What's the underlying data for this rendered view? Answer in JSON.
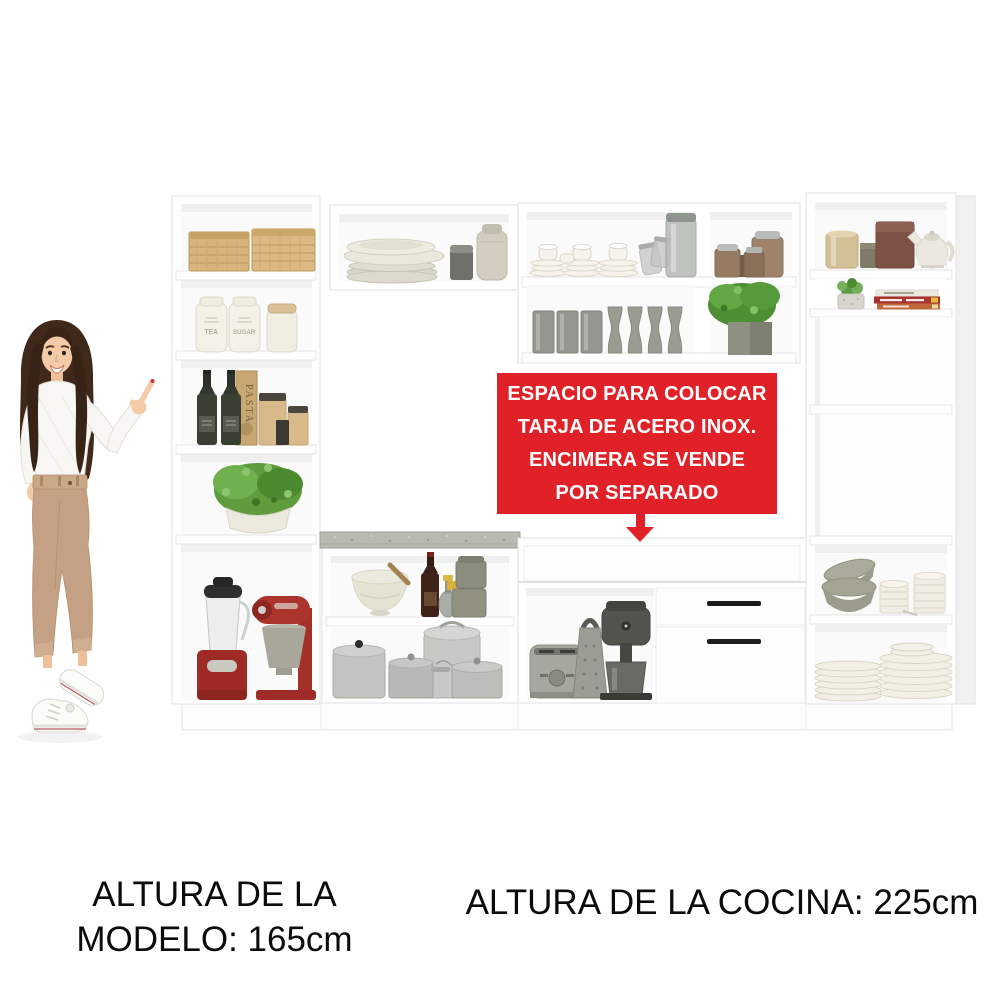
{
  "callout": {
    "lines": [
      "ESPACIO PARA COLOCAR",
      "TARJA DE ACERO INOX.",
      "ENCIMERA SE VENDE",
      "POR SEPARADO"
    ],
    "bg_color": "#e02127",
    "text_color": "#ffffff"
  },
  "captions": {
    "model_height_line1": "ALTURA DE LA",
    "model_height_line2": "MODELO: 165cm",
    "kitchen_height": "ALTURA DE LA COCINA: 225cm"
  },
  "product_labels": {
    "tea_jar": "TEA",
    "sugar_jar": "SUGAR",
    "pasta_box": "PASTA"
  },
  "colors": {
    "accent_red": "#e02127",
    "cabinet_white": "#ffffff",
    "countertop_gray": "#b7bab0",
    "appliance_red": "#9e2b26"
  }
}
